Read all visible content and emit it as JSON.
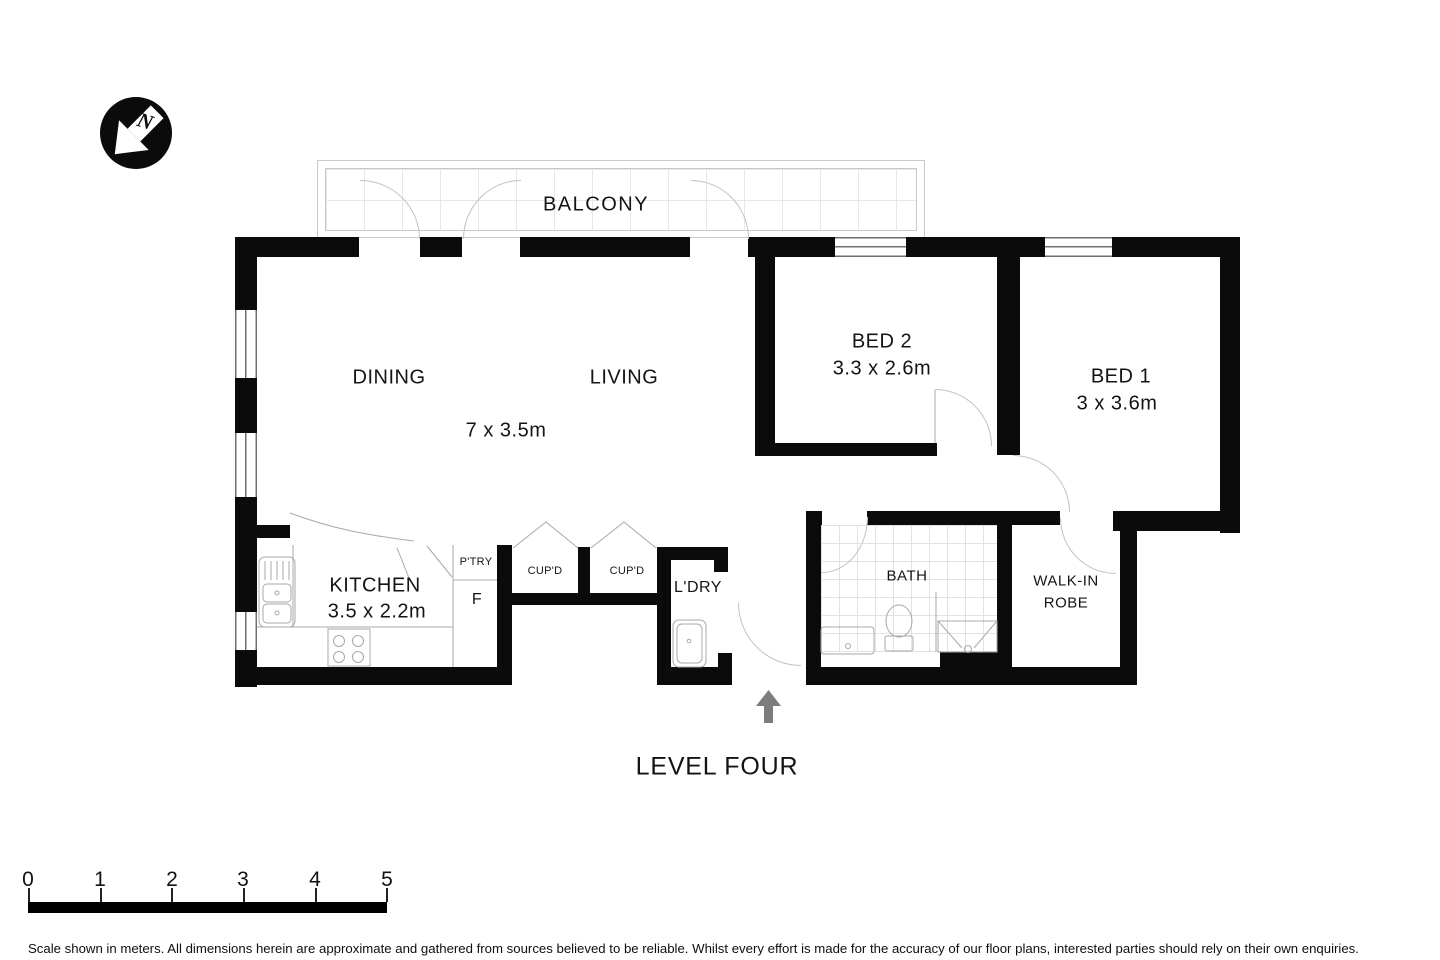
{
  "plan": {
    "level_label": "LEVEL FOUR",
    "compass_letter": "N",
    "balcony": {
      "label": "BALCONY"
    },
    "rooms": {
      "dining": {
        "label": "DINING"
      },
      "living": {
        "label": "LIVING",
        "dimensions": "7 x 3.5m"
      },
      "bed2": {
        "label": "BED 2",
        "dimensions": "3.3 x 2.6m"
      },
      "bed1": {
        "label": "BED 1",
        "dimensions": "3 x 3.6m"
      },
      "kitchen": {
        "label": "KITCHEN",
        "dimensions": "3.5 x 2.2m"
      },
      "pantry": {
        "label": "P'TRY"
      },
      "fridge": {
        "label": "F"
      },
      "cupboard_left": {
        "label": "CUP'D"
      },
      "cupboard_right": {
        "label": "CUP'D"
      },
      "laundry": {
        "label": "L'DRY"
      },
      "bath": {
        "label": "BATH"
      },
      "walk_in_robe": {
        "label": "WALK-IN ROBE"
      }
    }
  },
  "scale_bar": {
    "unit_labels": [
      "0",
      "1",
      "2",
      "3",
      "4",
      "5"
    ]
  },
  "disclaimer": "Scale shown in meters. All dimensions herein are approximate and gathered from sources believed to be  reliable. Whilst every effort is made for the accuracy of our floor plans, interested parties should rely on their own enquiries.",
  "colors": {
    "wall": "#0b0b0b",
    "door_line": "#c2c2c2",
    "fixture_line": "#a8a8a8",
    "entry_arrow": "#7d7d7d"
  }
}
